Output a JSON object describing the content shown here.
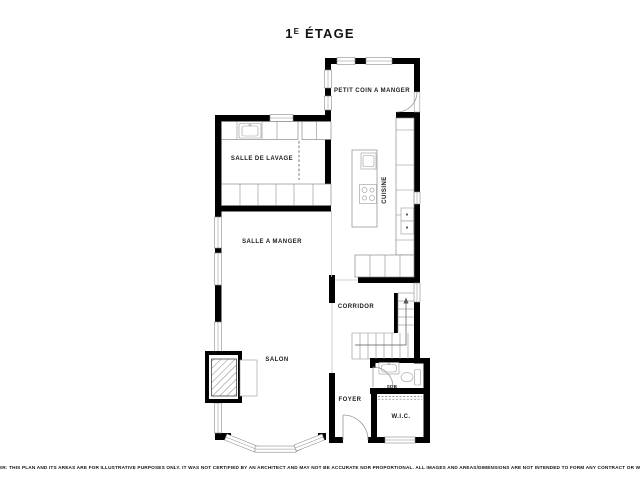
{
  "title": {
    "num": "1",
    "sup": "E",
    "rest": " ÉTAGE"
  },
  "rooms": {
    "petit_coin_a_manger": {
      "label": "PETIT COIN A MANGER"
    },
    "salle_de_lavage": {
      "label": "SALLE DE LAVAGE"
    },
    "cuisine": {
      "label": "CUISINE"
    },
    "salle_a_manger": {
      "label": "SALLE A MANGER"
    },
    "corridor": {
      "label": "CORRIDOR"
    },
    "salon": {
      "label": "SALON"
    },
    "foyer": {
      "label": "FOYER"
    },
    "sdb": {
      "label": "SDB"
    },
    "wic": {
      "label": "W.I.C."
    }
  },
  "disclaimer": "DISCLAIMER: THIS PLAN AND ITS AREAS ARE FOR ILLUSTRATIVE PURPOSES ONLY. IT WAS NOT CERTIFIED BY AN ARCHITECT AND MAY NOT BE ACCURATE NOR PROPORTIONAL. ALL IMAGES AND AREAS/DIMENSIONS ARE NOT INTENDED TO FORM ANY CONTRACT OR WARRANTY.",
  "colors": {
    "wall": "#000000",
    "fixture": "#8a8a8a",
    "background": "#ffffff",
    "text": "#1c1c1c"
  }
}
